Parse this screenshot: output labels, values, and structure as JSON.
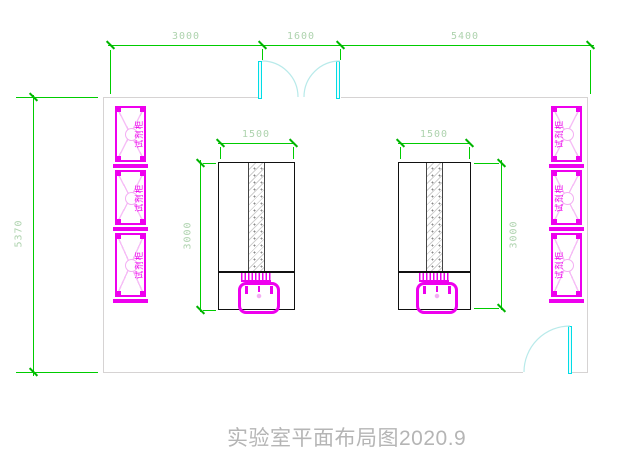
{
  "drawing": {
    "title": "实验室平面布局图2020.9",
    "dims": {
      "top_left": "3000",
      "top_middle": "1600",
      "top_right": "5400",
      "room_height": "5370",
      "island_width": "1500",
      "island_height": "3000"
    },
    "cabinet_label": "试剂柜",
    "colors": {
      "dimension_line": "#00cc00",
      "dimension_text": "#aed3ae",
      "cabinet": "#ee00ee",
      "door": "#00dde6",
      "wall": "#d6d3d3",
      "island_outline": "#111111",
      "title_text": "#b5b5b5"
    }
  }
}
